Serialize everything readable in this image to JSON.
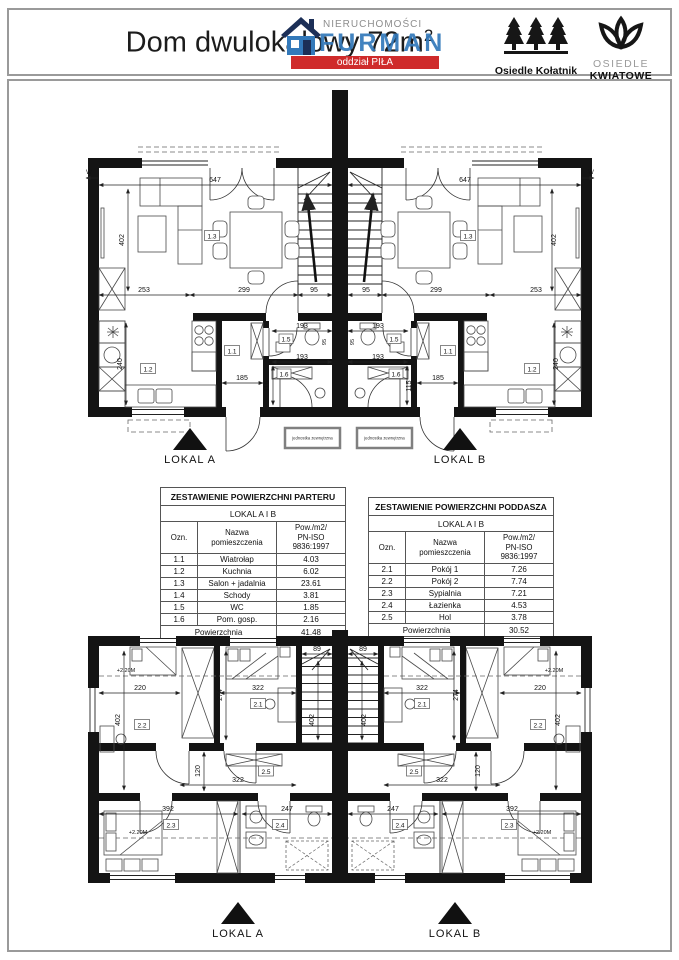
{
  "header": {
    "title": "Dom dwulokalowy 72m",
    "title_sup": "2",
    "watermark": {
      "line1": "NIERUCHOMOŚCI",
      "line2": "FURMAN",
      "line3": "oddział PIŁA",
      "colors": {
        "blue": "#3379ba",
        "red": "#cf2b2b",
        "navy": "#1c2f57"
      }
    },
    "logo_trees": {
      "label": "Osiedle Kołatnik"
    },
    "logo_flower": {
      "top": "OSIEDLE",
      "bottom": "KWIATOWE"
    }
  },
  "plan_parter": {
    "dims": {
      "total_w": "647",
      "living_h": "402",
      "seg_a": "253",
      "seg_b": "299",
      "seg_c": "95",
      "wc_w": "193",
      "gosp_w": "193",
      "hall_w": "185",
      "gosp_h": "115",
      "kitchen_h": "240",
      "wc_d": "95"
    },
    "rooms": {
      "wiatrolap": "1.1",
      "kuchnia": "1.2",
      "salon": "1.3",
      "wc": "1.5",
      "gosp": "1.6"
    },
    "labels": {
      "unit_a": "LOKAL A",
      "unit_b": "LOKAL B",
      "outdoor_unit": "jednostka zewnętrzna",
      "side_marker": "W"
    }
  },
  "plan_poddasze": {
    "dims": {
      "pokoj2_w": "220",
      "pokoj2_h": "402",
      "pokoj1_w": "322",
      "pokoj1_h": "274",
      "stairs_w": "89",
      "stairs_h": "402",
      "hol_w": "322",
      "hol_h": "120",
      "syp_w": "392",
      "laz_w": "247"
    },
    "rooms": {
      "pokoj1": "2.1",
      "pokoj2": "2.2",
      "sypialnia": "2.3",
      "lazienka": "2.4",
      "hol": "2.5"
    },
    "labels": {
      "unit_a": "LOKAL A",
      "unit_b": "LOKAL B",
      "height_note": "+2.20M"
    }
  },
  "tables": {
    "parter": {
      "title": "ZESTAWIENIE POWIERZCHNI PARTERU",
      "subtitle": "LOKAL  A I B",
      "col_ozn": "Ozn.",
      "col_name_1": "Nazwa",
      "col_name_2": "pomieszczenia",
      "col_area_1": "Pow./m2/",
      "col_area_2": "PN-ISO 9836:1997",
      "rows": [
        {
          "ozn": "1.1",
          "name": "Wiatrołap",
          "area": "4.03"
        },
        {
          "ozn": "1.2",
          "name": "Kuchnia",
          "area": "6.02"
        },
        {
          "ozn": "1.3",
          "name": "Salon + jadalnia",
          "area": "23.61"
        },
        {
          "ozn": "1.4",
          "name": "Schody",
          "area": "3.81"
        },
        {
          "ozn": "1.5",
          "name": "WC",
          "area": "1.85"
        },
        {
          "ozn": "1.6",
          "name": "Pom. gosp.",
          "area": "2.16"
        }
      ],
      "total_label": "Powierzchnia",
      "total_value": "41.48"
    },
    "poddasze": {
      "title": "ZESTAWIENIE POWIERZCHNI PODDASZA",
      "subtitle": "LOKAL  A I B",
      "col_ozn": "Ozn.",
      "col_name_1": "Nazwa",
      "col_name_2": "pomieszczenia",
      "col_area_1": "Pow./m2/",
      "col_area_2": "PN-ISO 9836:1997",
      "rows": [
        {
          "ozn": "2.1",
          "name": "Pokój 1",
          "area": "7.26"
        },
        {
          "ozn": "2.2",
          "name": "Pokój 2",
          "area": "7.74"
        },
        {
          "ozn": "2.3",
          "name": "Sypialnia",
          "area": "7.21"
        },
        {
          "ozn": "2.4",
          "name": "Łazienka",
          "area": "4.53"
        },
        {
          "ozn": "2.5",
          "name": "Hol",
          "area": "3.78"
        }
      ],
      "total_label": "Powierzchnia",
      "total_value": "30.52"
    }
  }
}
